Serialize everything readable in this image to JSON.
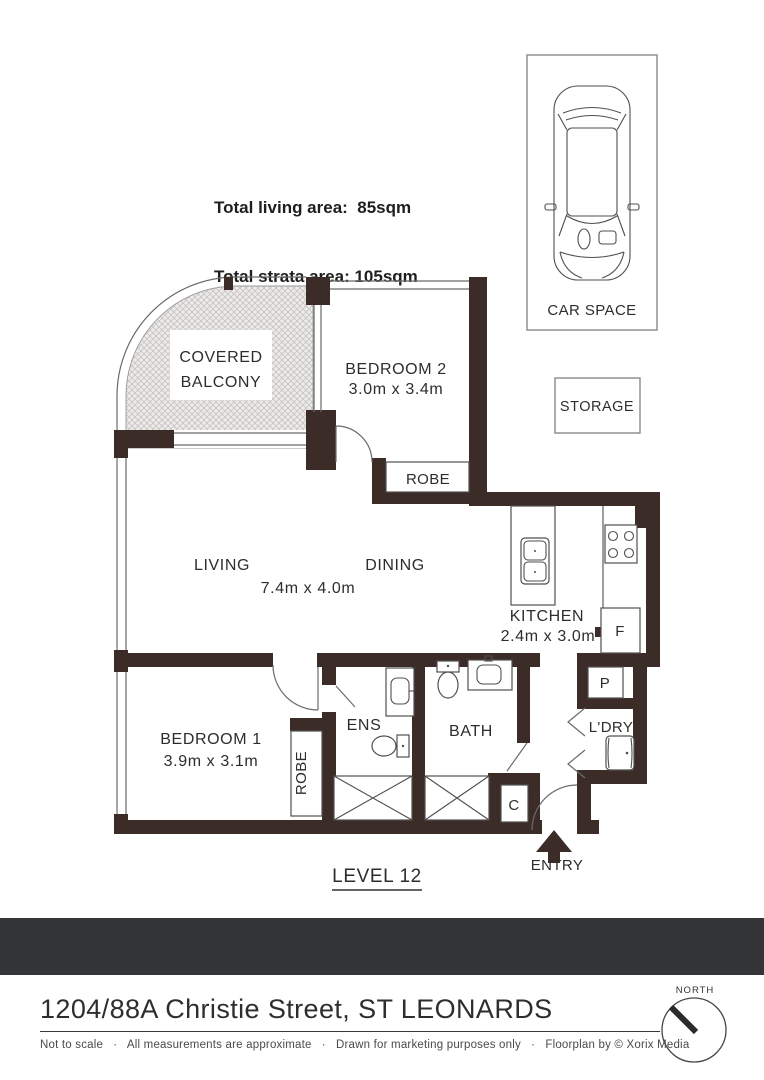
{
  "stats": {
    "living": "Total living area:  85sqm",
    "strata": "Total strata area: 105sqm"
  },
  "parking": {
    "car_space": "CAR SPACE",
    "storage": "STORAGE"
  },
  "rooms": {
    "balcony_line1": "COVERED",
    "balcony_line2": "BALCONY",
    "bedroom2_name": "BEDROOM 2",
    "bedroom2_dims": "3.0m x 3.4m",
    "bedroom2_robe": "ROBE",
    "living": "LIVING",
    "dining": "DINING",
    "living_dining_dims": "7.4m x 4.0m",
    "kitchen_name": "KITCHEN",
    "kitchen_dims": "2.4m x 3.0m",
    "fridge": "F",
    "pantry": "P",
    "laundry": "L'DRY",
    "bedroom1_name": "BEDROOM 1",
    "bedroom1_dims": "3.9m x 3.1m",
    "bedroom1_robe": "ROBE",
    "ensuite": "ENS",
    "bath": "BATH",
    "cupboard": "C",
    "entry": "ENTRY"
  },
  "level": "LEVEL 12",
  "address": "1204/88A Christie Street, ST LEONARDS",
  "disclaimer": "Not to scale   ·   All measurements are approximate   ·   Drawn for marketing purposes only   ·   Floorplan by © Xorix Media",
  "compass": {
    "north": "NORTH"
  },
  "colors": {
    "wall": "#3C2C27",
    "bar": "#333538"
  }
}
